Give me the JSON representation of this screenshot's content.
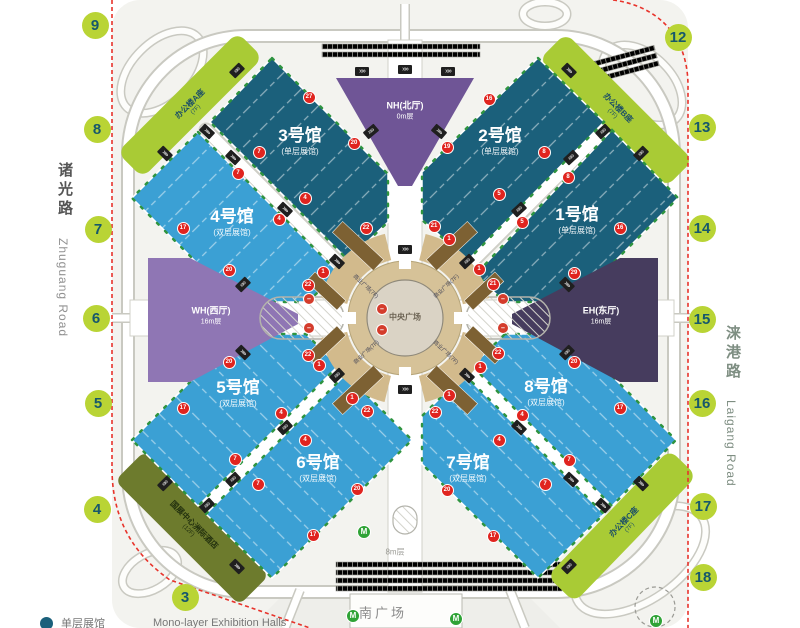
{
  "colors": {
    "hall_dark": "#1b607b",
    "hall_light": "#3ba0d4",
    "office_green": "#a9cb35",
    "hotel_olive": "#6d7b2d",
    "north_hall": "#6f5596",
    "west_hall": "#8f76b4",
    "east_hall": "#463c5e",
    "gate_bg": "#b9d435",
    "gate_text": "#17586b",
    "marker_red": "#e0241f",
    "boundary_red": "#e8332b",
    "plaza_tan": "#d2ba8c",
    "brown": "#7d6133",
    "metro_green": "#2fa336"
  },
  "roads": {
    "left": {
      "cn": "诸光路",
      "en": "Zhuguang Road"
    },
    "right": {
      "cn": "涞港路",
      "en": "Laigang Road"
    }
  },
  "gates": [
    {
      "n": "9",
      "x": 95,
      "y": 25
    },
    {
      "n": "8",
      "x": 97,
      "y": 129
    },
    {
      "n": "7",
      "x": 98,
      "y": 229
    },
    {
      "n": "6",
      "x": 96,
      "y": 318
    },
    {
      "n": "5",
      "x": 98,
      "y": 403
    },
    {
      "n": "4",
      "x": 97,
      "y": 509
    },
    {
      "n": "3",
      "x": 185,
      "y": 597
    },
    {
      "n": "12",
      "x": 678,
      "y": 37
    },
    {
      "n": "13",
      "x": 702,
      "y": 127
    },
    {
      "n": "14",
      "x": 702,
      "y": 228
    },
    {
      "n": "15",
      "x": 702,
      "y": 319
    },
    {
      "n": "16",
      "x": 702,
      "y": 403
    },
    {
      "n": "17",
      "x": 703,
      "y": 506
    },
    {
      "n": "18",
      "x": 703,
      "y": 577
    }
  ],
  "halls": [
    {
      "id": "hall-1",
      "name": "1号馆",
      "sub": "(单层展馆)",
      "x": 577,
      "y": 218
    },
    {
      "id": "hall-2",
      "name": "2号馆",
      "sub": "(单层展馆)",
      "x": 500,
      "y": 139
    },
    {
      "id": "hall-3",
      "name": "3号馆",
      "sub": "(单层展馆)",
      "x": 300,
      "y": 139
    },
    {
      "id": "hall-4",
      "name": "4号馆",
      "sub": "(双层展馆)",
      "x": 232,
      "y": 220
    },
    {
      "id": "hall-5",
      "name": "5号馆",
      "sub": "(双层展馆)",
      "x": 238,
      "y": 391
    },
    {
      "id": "hall-6",
      "name": "6号馆",
      "sub": "(双层展馆)",
      "x": 318,
      "y": 466
    },
    {
      "id": "hall-7",
      "name": "7号馆",
      "sub": "(双层展馆)",
      "x": 468,
      "y": 466
    },
    {
      "id": "hall-8",
      "name": "8号馆",
      "sub": "(双层展馆)",
      "x": 546,
      "y": 390
    }
  ],
  "lobbies": [
    {
      "id": "north-lobby",
      "name": "NH(北厅)",
      "level": "0m层",
      "x": 405,
      "y": 110
    },
    {
      "id": "west-lobby",
      "name": "WH(西厅)",
      "level": "16m层",
      "x": 211,
      "y": 315
    },
    {
      "id": "east-lobby",
      "name": "EH(东厅)",
      "level": "16m层",
      "x": 601,
      "y": 315
    }
  ],
  "buildings": [
    {
      "id": "office-a",
      "name": "办公楼A座",
      "sub": "(7F)",
      "x": 192,
      "y": 106,
      "rot": -45,
      "cls": ""
    },
    {
      "id": "office-b",
      "name": "办公楼B座",
      "sub": "(7F)",
      "x": 616,
      "y": 110,
      "rot": 45,
      "cls": ""
    },
    {
      "id": "office-c",
      "name": "办公楼C座",
      "sub": "(7F)",
      "x": 626,
      "y": 524,
      "rot": -46,
      "cls": ""
    },
    {
      "id": "hotel",
      "name": "国展中心洲际酒店",
      "sub": "(12F)",
      "x": 192,
      "y": 527,
      "rot": 45,
      "cls": "hotel"
    }
  ],
  "plaza": {
    "name": "中央广场",
    "x": 405,
    "y": 317,
    "quadrants": [
      {
        "label": "商业广场(7F)",
        "x": 366,
        "y": 286,
        "rot": 43
      },
      {
        "label": "商业广场(7F)",
        "x": 446,
        "y": 286,
        "rot": -43
      },
      {
        "label": "商业广场(7F)",
        "x": 366,
        "y": 352,
        "rot": -43
      },
      {
        "label": "商业广场(7F)",
        "x": 446,
        "y": 352,
        "rot": 43
      }
    ]
  },
  "south": {
    "name": "南广场",
    "x": 383,
    "y": 612,
    "level": "8m层",
    "level_x": 395,
    "level_y": 552
  },
  "legend": {
    "label_cn": "单层展馆",
    "label_en": "Mono-layer Exhibition Halls"
  },
  "markers": [
    {
      "n": "27",
      "x": 308,
      "y": 96
    },
    {
      "n": "20",
      "x": 353,
      "y": 142
    },
    {
      "n": "7",
      "x": 258,
      "y": 151
    },
    {
      "n": "7",
      "x": 237,
      "y": 172
    },
    {
      "n": "4",
      "x": 304,
      "y": 197
    },
    {
      "n": "4",
      "x": 278,
      "y": 218
    },
    {
      "n": "17",
      "x": 182,
      "y": 227
    },
    {
      "n": "22",
      "x": 365,
      "y": 227
    },
    {
      "n": "20",
      "x": 228,
      "y": 269
    },
    {
      "n": "1",
      "x": 322,
      "y": 271
    },
    {
      "n": "22",
      "x": 307,
      "y": 284
    },
    {
      "n": "16",
      "x": 488,
      "y": 98
    },
    {
      "n": "19",
      "x": 446,
      "y": 146
    },
    {
      "n": "8",
      "x": 543,
      "y": 151
    },
    {
      "n": "8",
      "x": 567,
      "y": 176
    },
    {
      "n": "5",
      "x": 498,
      "y": 193
    },
    {
      "n": "5",
      "x": 521,
      "y": 221
    },
    {
      "n": "21",
      "x": 433,
      "y": 225
    },
    {
      "n": "1",
      "x": 448,
      "y": 238
    },
    {
      "n": "16",
      "x": 619,
      "y": 227
    },
    {
      "n": "1",
      "x": 478,
      "y": 268
    },
    {
      "n": "21",
      "x": 492,
      "y": 283
    },
    {
      "n": "29",
      "x": 573,
      "y": 272
    },
    {
      "n": "20",
      "x": 228,
      "y": 361
    },
    {
      "n": "1",
      "x": 318,
      "y": 364
    },
    {
      "n": "22",
      "x": 307,
      "y": 354
    },
    {
      "n": "17",
      "x": 182,
      "y": 407
    },
    {
      "n": "4",
      "x": 280,
      "y": 412
    },
    {
      "n": "1",
      "x": 351,
      "y": 397
    },
    {
      "n": "22",
      "x": 366,
      "y": 410
    },
    {
      "n": "4",
      "x": 304,
      "y": 439
    },
    {
      "n": "7",
      "x": 234,
      "y": 458
    },
    {
      "n": "7",
      "x": 257,
      "y": 483
    },
    {
      "n": "20",
      "x": 356,
      "y": 488
    },
    {
      "n": "17",
      "x": 312,
      "y": 534
    },
    {
      "n": "22",
      "x": 497,
      "y": 352
    },
    {
      "n": "1",
      "x": 479,
      "y": 366
    },
    {
      "n": "20",
      "x": 573,
      "y": 361
    },
    {
      "n": "1",
      "x": 448,
      "y": 394
    },
    {
      "n": "22",
      "x": 434,
      "y": 411
    },
    {
      "n": "4",
      "x": 521,
      "y": 414
    },
    {
      "n": "17",
      "x": 619,
      "y": 407
    },
    {
      "n": "4",
      "x": 498,
      "y": 439
    },
    {
      "n": "7",
      "x": 568,
      "y": 459
    },
    {
      "n": "7",
      "x": 544,
      "y": 483
    },
    {
      "n": "20",
      "x": 446,
      "y": 489
    },
    {
      "n": "17",
      "x": 492,
      "y": 535
    }
  ],
  "no_entry": [
    {
      "x": 381,
      "y": 308
    },
    {
      "x": 381,
      "y": 329
    },
    {
      "x": 308,
      "y": 298
    },
    {
      "x": 308,
      "y": 327
    },
    {
      "x": 502,
      "y": 298
    },
    {
      "x": 502,
      "y": 327
    }
  ],
  "metro": [
    {
      "x": 363,
      "y": 531
    },
    {
      "x": 352,
      "y": 615
    },
    {
      "x": 455,
      "y": 618
    },
    {
      "x": 655,
      "y": 620
    }
  ],
  "bridges": [
    {
      "x": 233,
      "y": 157,
      "r": 43
    },
    {
      "x": 285,
      "y": 209,
      "r": 43
    },
    {
      "x": 337,
      "y": 261,
      "r": 43
    },
    {
      "x": 571,
      "y": 157,
      "r": -43
    },
    {
      "x": 519,
      "y": 209,
      "r": -43
    },
    {
      "x": 467,
      "y": 261,
      "r": -43
    },
    {
      "x": 233,
      "y": 479,
      "r": -43
    },
    {
      "x": 285,
      "y": 427,
      "r": -43
    },
    {
      "x": 337,
      "y": 375,
      "r": -43
    },
    {
      "x": 571,
      "y": 479,
      "r": 43
    },
    {
      "x": 519,
      "y": 427,
      "r": 43
    },
    {
      "x": 467,
      "y": 375,
      "r": 43
    },
    {
      "x": 207,
      "y": 131,
      "r": 43
    },
    {
      "x": 603,
      "y": 131,
      "r": -43
    },
    {
      "x": 207,
      "y": 505,
      "r": -43
    },
    {
      "x": 603,
      "y": 505,
      "r": 43
    },
    {
      "x": 237,
      "y": 70,
      "r": -45
    },
    {
      "x": 165,
      "y": 153,
      "r": 45
    },
    {
      "x": 569,
      "y": 70,
      "r": 45
    },
    {
      "x": 641,
      "y": 153,
      "r": -45
    },
    {
      "x": 165,
      "y": 483,
      "r": -45
    },
    {
      "x": 237,
      "y": 566,
      "r": 45
    },
    {
      "x": 641,
      "y": 483,
      "r": 45
    },
    {
      "x": 569,
      "y": 566,
      "r": -45
    },
    {
      "x": 362,
      "y": 71,
      "r": 0
    },
    {
      "x": 405,
      "y": 69,
      "r": 0
    },
    {
      "x": 448,
      "y": 71,
      "r": 0
    },
    {
      "x": 371,
      "y": 131,
      "r": -40
    },
    {
      "x": 439,
      "y": 131,
      "r": 40
    },
    {
      "x": 243,
      "y": 284,
      "r": -45
    },
    {
      "x": 243,
      "y": 352,
      "r": 45
    },
    {
      "x": 567,
      "y": 284,
      "r": 45
    },
    {
      "x": 567,
      "y": 352,
      "r": -45
    },
    {
      "x": 405,
      "y": 249,
      "r": 0
    },
    {
      "x": 405,
      "y": 389,
      "r": 0
    }
  ]
}
